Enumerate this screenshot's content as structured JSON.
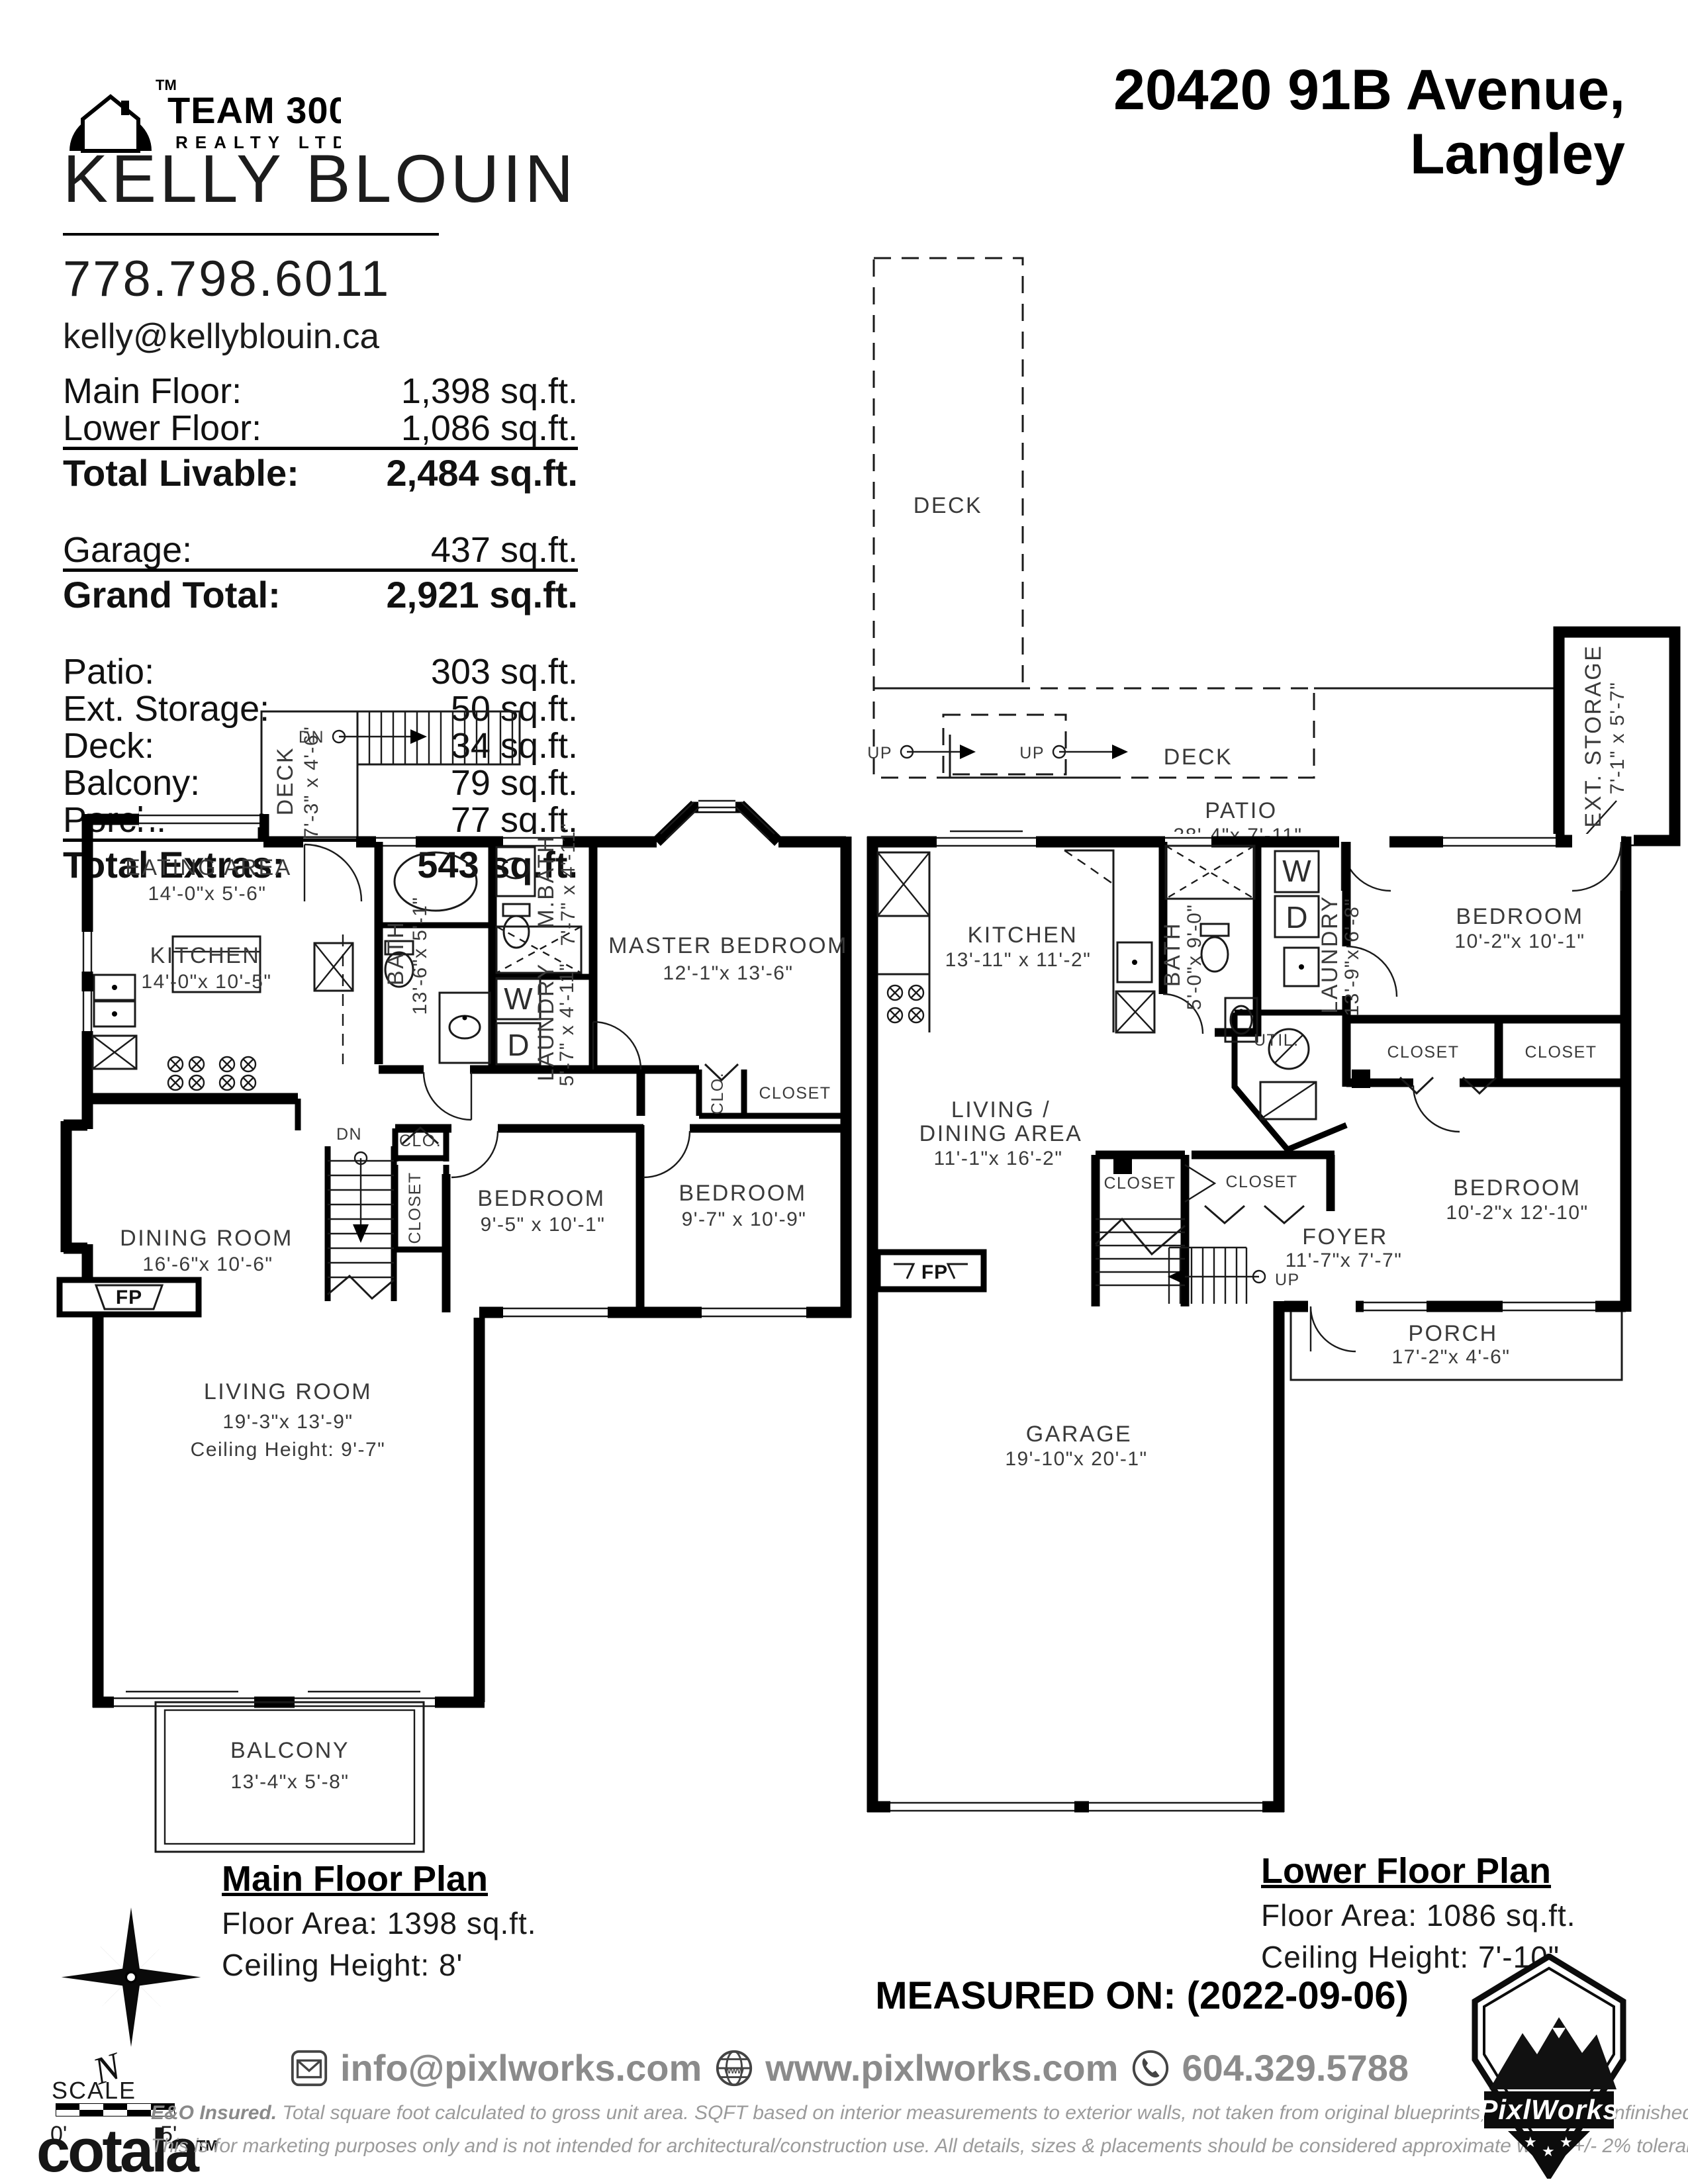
{
  "header": {
    "brand": {
      "team": "TEAM 3000",
      "realty": "REALTY LTD",
      "tm": "TM"
    },
    "agent": {
      "name": "KELLY BLOUIN",
      "phone": "778.798.6011",
      "email": "kelly@kellyblouin.ca"
    },
    "address": {
      "line1": "20420 91B Avenue,",
      "line2": "Langley"
    }
  },
  "areas": {
    "groups": [
      {
        "rows": [
          {
            "label": "Main Floor:",
            "value": "1,398 sq.ft."
          },
          {
            "label": "Lower Floor:",
            "value": "1,086 sq.ft."
          }
        ],
        "total": {
          "label": "Total Livable:",
          "value": "2,484 sq.ft."
        }
      },
      {
        "rows": [
          {
            "label": "Garage:",
            "value": "437 sq.ft."
          }
        ],
        "total": {
          "label": "Grand Total:",
          "value": "2,921 sq.ft."
        }
      },
      {
        "rows": [
          {
            "label": "Patio:",
            "value": "303 sq.ft."
          },
          {
            "label": "Ext. Storage:",
            "value": "50 sq.ft."
          },
          {
            "label": "Deck:",
            "value": "34 sq.ft."
          },
          {
            "label": "Balcony:",
            "value": "79 sq.ft."
          },
          {
            "label": "Porch:",
            "value": "77 sq.ft."
          }
        ],
        "total": {
          "label": "Total Extras:",
          "value": "543 sq.ft."
        }
      }
    ]
  },
  "main_floor": {
    "title": "Main Floor Plan",
    "area": "Floor Area: 1398 sq.ft.",
    "ceiling": "Ceiling Height: 8'",
    "deck": {
      "name": "DECK",
      "dims": "7'-3\" x 4'-6\""
    },
    "dn1": "DN",
    "dn2": "DN",
    "eating": {
      "name": "EATING AREA",
      "dims": "14'-0\"x  5'-6\""
    },
    "kitchen": {
      "name": "KITCHEN",
      "dims": "14'-0\"x 10'-5\""
    },
    "bath": {
      "name": "BATH",
      "dims": "13'-6\"x 5'-1\""
    },
    "mbath": {
      "name": "M.BATH",
      "dims": "7'-7\" x 4'-11\""
    },
    "laundry": {
      "name": "LAUNDRY",
      "dims": "5'-7\"  x 4'-11\""
    },
    "washer": "W",
    "dryer": "D",
    "master": {
      "name": "MASTER BEDROOM",
      "dims": "12'-1\"x 13'-6\""
    },
    "clo1": "CLO.",
    "closet1": "CLOSET",
    "clo2": "CLO.",
    "closet2": "CLOSET",
    "bedroom1": {
      "name": "BEDROOM",
      "dims": "9'-5\" x 10'-1\""
    },
    "bedroom2": {
      "name": "BEDROOM",
      "dims": "9'-7\" x 10'-9\""
    },
    "dining": {
      "name": "DINING ROOM",
      "dims": "16'-6\"x 10'-6\""
    },
    "fp": "FP",
    "living": {
      "name": "LIVING ROOM",
      "dims": "19'-3\"x 13'-9\"",
      "ceiling": "Ceiling Height: 9'-7\""
    },
    "balcony": {
      "name": "BALCONY",
      "dims": "13'-4\"x  5'-8\""
    }
  },
  "lower_floor": {
    "title": "Lower Floor Plan",
    "area": "Floor Area: 1086 sq.ft.",
    "ceiling": "Ceiling Height: 7'-10\"",
    "deck1": "DECK",
    "deck2": "DECK",
    "up1": "UP",
    "up2": "UP",
    "up3": "UP",
    "patio": {
      "name": "PATIO",
      "dims": "38'-4\"x 7'-11\""
    },
    "ext_storage": {
      "name": "EXT. STORAGE",
      "dims": "7'-1\" x  5'-7\""
    },
    "kitchen": {
      "name": "KITCHEN",
      "dims": "13'-11\" x 11'-2\""
    },
    "bath": {
      "name": "BATH",
      "dims": "5'-0\"x 9'-0\""
    },
    "washer": "W",
    "dryer": "D",
    "laundry": {
      "name": "LAUNDRY",
      "dims": "13'-9\"x  6'-8\""
    },
    "util": "UTIL.",
    "bedroom1": {
      "name": "BEDROOM",
      "dims": "10'-2\"x 10'-1\""
    },
    "closet1": "CLOSET",
    "closet2": "CLOSET",
    "closet3": "CLOSET",
    "closet4": "CLOSET",
    "living": {
      "name1": "LIVING /",
      "name2": "DINING AREA",
      "dims": "11'-1\"x 16'-2\""
    },
    "bedroom2": {
      "name": "BEDROOM",
      "dims": "10'-2\"x 12'-10\""
    },
    "foyer": {
      "name": "FOYER",
      "dims": "11'-7\"x  7'-7\""
    },
    "fp": "FP",
    "porch": {
      "name": "PORCH",
      "dims": "17'-2\"x  4'-6\""
    },
    "garage": {
      "name": "GARAGE",
      "dims": "19'-10\"x 20'-1\""
    }
  },
  "footer": {
    "north": "N",
    "scale": "SCALE",
    "scale0": "0'",
    "scale5": "5'",
    "cotala": "cotala",
    "cotala_tm": "TM",
    "measured": "MEASURED ON: (2022-09-06)",
    "email": "info@pixlworks.com",
    "website": "www.pixlworks.com",
    "phone": "604.329.5788",
    "disc1_bold": "E&O Insured.",
    "disc1": " Total square foot calculated to gross unit area. SQFT based on interior measurements to exterior walls, not taken from original blueprints, may include unfinished area.",
    "disc2": "This is for marketing purposes only and is not intended for architectural/construction use.  All details, sizes & placements should be considered approximate within +/- 2%  tolerance.",
    "pixlworks": "PixlWorks"
  }
}
